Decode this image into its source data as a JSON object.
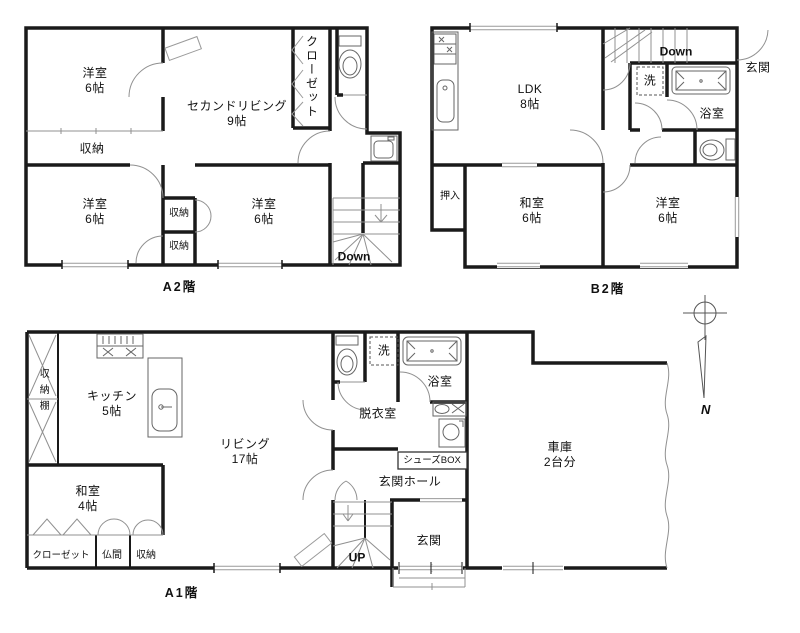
{
  "a2": {
    "caption": "A2階",
    "bedroom_nw": "洋室\n6帖",
    "second_living": "セカンドリビング\n9帖",
    "closet": "クローゼット",
    "storage_top": "収納",
    "bedroom_sw": "洋室\n6帖",
    "storage_mid": "収納",
    "storage_bot": "収納",
    "bedroom_se": "洋室\n6帖",
    "stairs": "Down"
  },
  "b2": {
    "caption": "B2階",
    "ldk": "LDK\n8帖",
    "stairs": "Down",
    "entrance": "玄関",
    "laundry": "洗",
    "bath": "浴室",
    "oshiire": "押入",
    "washitsu": "和室\n6帖",
    "bedroom": "洋室\n6帖"
  },
  "a1": {
    "caption": "A1階",
    "storage_shelf": "収納棚",
    "kitchen": "キッチン\n5帖",
    "living": "リビング\n17帖",
    "laundry": "洗",
    "bath": "浴室",
    "dressing": "脱衣室",
    "shoes_box": "シューズBOX",
    "entrance_hall": "玄関ホール",
    "washitsu": "和室\n4帖",
    "closet": "クローゼット",
    "butsuma": "仏間",
    "storage": "収納",
    "entrance": "玄関",
    "stairs": "UP",
    "garage": "車庫\n2台分"
  },
  "compass": {
    "north": "N"
  },
  "colors": {
    "wall": "#1a1a1a",
    "thin": "#909090",
    "fixture": "#666666",
    "paper": "#ffffff"
  }
}
